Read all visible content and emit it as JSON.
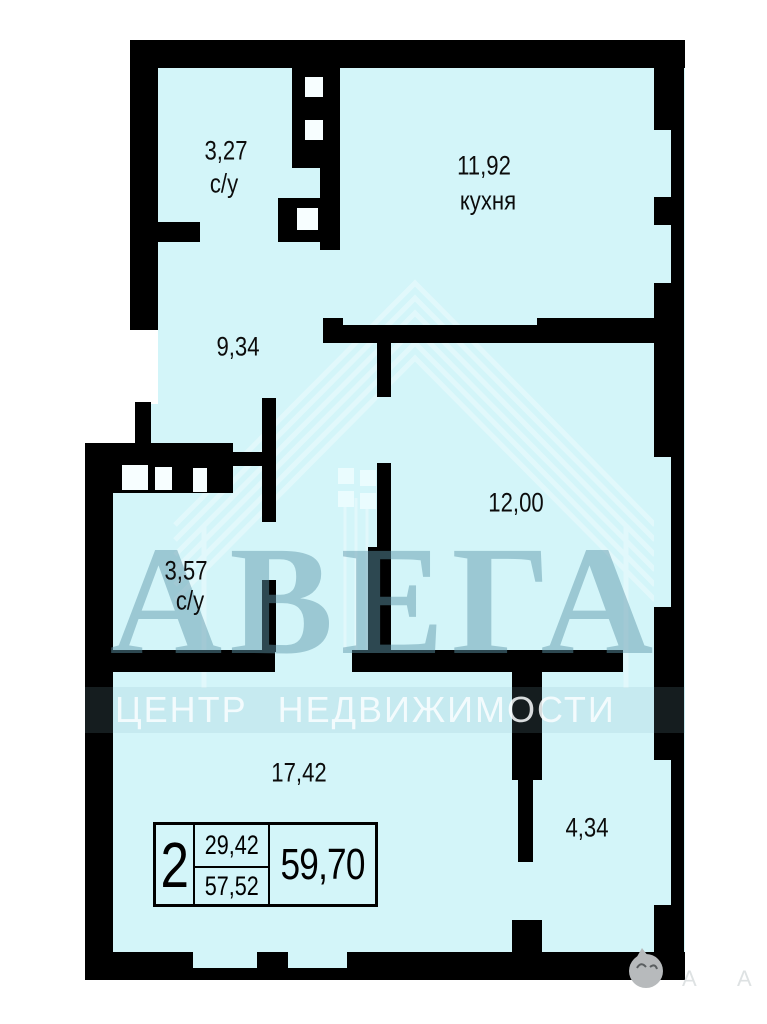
{
  "plan_type": "apartment-floor-plan",
  "rooms": [
    {
      "area": "3,27",
      "type": "с/у"
    },
    {
      "area": "11,92",
      "type": "кухня"
    },
    {
      "area": "9,34",
      "type": ""
    },
    {
      "area": "12,00",
      "type": ""
    },
    {
      "area": "3,57",
      "type": "с/у"
    },
    {
      "area": "17,42",
      "type": ""
    },
    {
      "area": "4,34",
      "type": ""
    }
  ],
  "info_box": {
    "rooms_count": "2",
    "area_upper": "29,42",
    "area_lower": "57,52",
    "area_total": "59,70"
  },
  "watermark": {
    "brand": "АВЕГА",
    "tagline": "ЦЕНТР НЕДВИЖИМОСТИ",
    "corner_letter": "А"
  },
  "colors": {
    "floor": "#d3f5f9",
    "wall": "#000000",
    "background": "#ffffff",
    "brand_watermark": "rgba(95,150,170,0.48)"
  }
}
